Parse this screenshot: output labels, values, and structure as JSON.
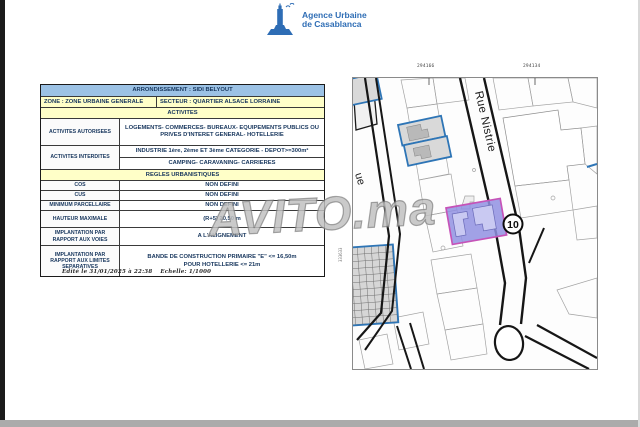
{
  "header": {
    "agency_name_line1": "Agence Urbaine",
    "agency_name_line2": "de Casablanca",
    "logo_color": "#2e6db5"
  },
  "table": {
    "title": "ARRONDISSEMENT : SIDI BELYOUT",
    "zone": "ZONE : ZONE URBAINE GENERALE",
    "secteur": "SECTEUR : QUARTIER ALSACE LORRAINE",
    "activites_header": "ACTIVITES",
    "activites_autorisees_label": "ACTIVITES AUTORISEES",
    "activites_autorisees_value": "LOGEMENTS- COMMERCES- BUREAUX- EQUIPEMENTS PUBLICS OU PRIVES D'INTERET GENERAL- HOTELLERIE",
    "activites_interdites_label": "ACTIVITES INTERDITES",
    "activites_interdites_value1": "INDUSTRIE 1ère, 2ème ET 3ème CATEGORIE - DEPOT>=300m²",
    "activites_interdites_value2": "CAMPING- CARAVANING- CARRIERES",
    "regles_header": "REGLES URBANISTIQUES",
    "cos_label": "COS",
    "cos_value": "NON DEFINI",
    "cus_label": "CUS",
    "cus_value": "NON DEFINI",
    "minimum_label": "MINIMUM PARCELLAIRE",
    "minimum_value": "NON DEFINI",
    "hauteur_label": "HAUTEUR MAXIMALE",
    "hauteur_value": "(R+5) 20,50 m",
    "impl_voies_label": "IMPLANTATION PAR RAPPORT AUX VOIES",
    "impl_voies_value": "A L'ALIGNEMENT",
    "impl_limites_label": "IMPLANTATION PAR RAPPORT AUX LIMITES SEPARATIVES",
    "impl_limites_value1": "BANDE DE CONSTRUCTION PRIMAIRE \"E\" <= 16,50m",
    "impl_limites_value2": "POUR HOTELLERIE <= 21m"
  },
  "footer": {
    "edit_note": "Edité le 31/01/2025 à 22:38",
    "scale_note": "Echelle: 1/1000"
  },
  "map": {
    "coord_top_left": "294166",
    "coord_top_right": "294134",
    "coord_left": "333633",
    "street_name": "Rue Nistrie",
    "street_name_partial": "ue",
    "route_number": "10"
  },
  "watermark": {
    "text": "AVITO.ma"
  },
  "colors": {
    "accent_blue": "#2e75b6",
    "title_row_bg": "#9cc2e5",
    "section_row_bg": "#ffffc8",
    "subject_parcel_fill": "#9090e2",
    "subject_parcel_border": "#c653b8"
  }
}
